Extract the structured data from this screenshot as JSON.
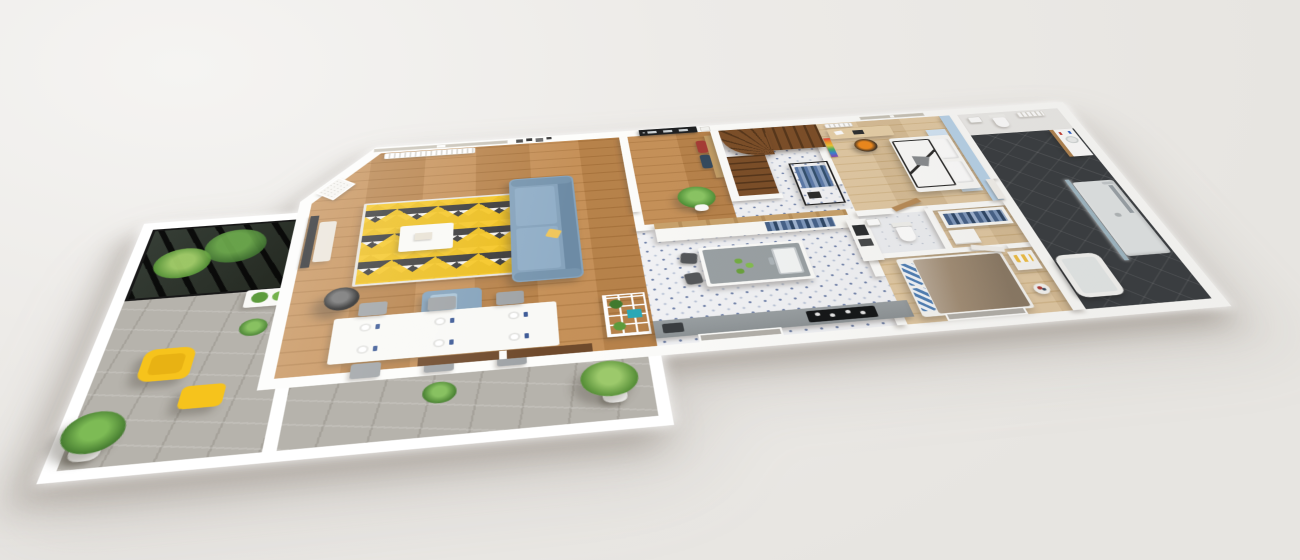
{
  "scene": {
    "title": "3D isometric floor plan — single-storey home with wrap-around terrace",
    "type": "architectural 3D floor plan render",
    "background_color": "#EDEBE8",
    "outline_color": "#FFFFFF"
  },
  "palette": {
    "wall_white": "#FDFDFB",
    "oak_floor": "#C28A4F",
    "light_wood_floor": "#E0C59C",
    "cement_tile_white": "#F2F3F6",
    "cement_tile_blue": "#6D7FA8",
    "terrace_stone": "#B6B3AC",
    "bathroom_tile": "#393D41",
    "sofa_blue": "#86A3BC",
    "accent_yellow": "#F6C31C",
    "stair_wood": "#7C4E28",
    "accent_wall_blue": "#B9D4EA",
    "gaming_chair_orange": "#F08A1C",
    "front_door_black": "#1E2022",
    "duvet_taupe": "#A28E76"
  },
  "rooms": [
    {
      "id": "terrace",
      "name": "Terrace",
      "floor": "grey stone pavers",
      "items": [
        "black glass canopy garden with plants",
        "yellow armchair",
        "yellow footrest",
        "potted palm",
        "potted plants",
        "white planter"
      ]
    },
    {
      "id": "living-room",
      "name": "Living room",
      "floor": "oak parquet",
      "items": [
        "blue three-seat sofa with yellow cushion",
        "blue ottoman with throw",
        "triangle-pattern rug white black yellow",
        "white coffee table",
        "black floor lamp",
        "wall-mounted TV",
        "media cabinet",
        "window with roller blinds",
        "radiator",
        "framed photos",
        "framed map poster on angled wall"
      ]
    },
    {
      "id": "dining-area",
      "name": "Dining area",
      "floor": "oak parquet",
      "items": [
        "white dining table with six place settings",
        "six grey chairs",
        "white shelving rack with plants and teal box",
        "sliding-door threshold to terrace"
      ]
    },
    {
      "id": "entrance",
      "name": "Entrance hall",
      "floor": "oak parquet",
      "items": [
        "black front door with three glazing slits",
        "wall mirror",
        "wood coat panel with hanging clothes",
        "potted palm"
      ]
    },
    {
      "id": "staircase",
      "name": "Staircase",
      "floor": "blue patterned cement tiles",
      "items": [
        "dark wood winder staircase",
        "white guard wall"
      ]
    },
    {
      "id": "hallway",
      "name": "Hallway",
      "floor": "blue patterned cement tiles",
      "items": [
        "black open clothes rack with hanging clothes",
        "white sideboard with wood top"
      ]
    },
    {
      "id": "kitchen",
      "name": "Kitchen",
      "floor": "blue patterned cement tiles",
      "items": [
        "island with white sink and faucet",
        "two dark bar stools",
        "green apples on island",
        "grey worktop with black induction hob",
        "tall oven cabinet",
        "window to front"
      ]
    },
    {
      "id": "teen-bedroom",
      "name": "Bedroom 2",
      "floor": "light wood",
      "items": [
        "white double bed with black piping",
        "two white pillows",
        "grey headrest wedge",
        "light-blue accent wall and headboard panel",
        "desk",
        "orange and black gaming chair",
        "multicolour llama wall art",
        "window",
        "radiator"
      ]
    },
    {
      "id": "wc",
      "name": "WC",
      "floor": "light tiles",
      "items": [
        "toilet",
        "hand basin",
        "wooden door"
      ]
    },
    {
      "id": "dressing",
      "name": "Dressing",
      "floor": "light wood",
      "items": [
        "open wardrobe with hanging blue clothes",
        "white drawer unit"
      ]
    },
    {
      "id": "master-bedroom",
      "name": "Master bedroom",
      "floor": "light wood",
      "items": [
        "double bed with taupe duvet",
        "blue-white striped pillows",
        "bedside bench with yellow striped cushion",
        "laundry basket",
        "window to front"
      ]
    },
    {
      "id": "bathroom",
      "name": "Bathroom",
      "floor": "anthracite tiles",
      "items": [
        "vanity with basin and wood drawers",
        "towel radiator",
        "toilet",
        "hand basin",
        "walk-in shower with glass screen and chrome column",
        "built-in bathtub"
      ]
    }
  ]
}
